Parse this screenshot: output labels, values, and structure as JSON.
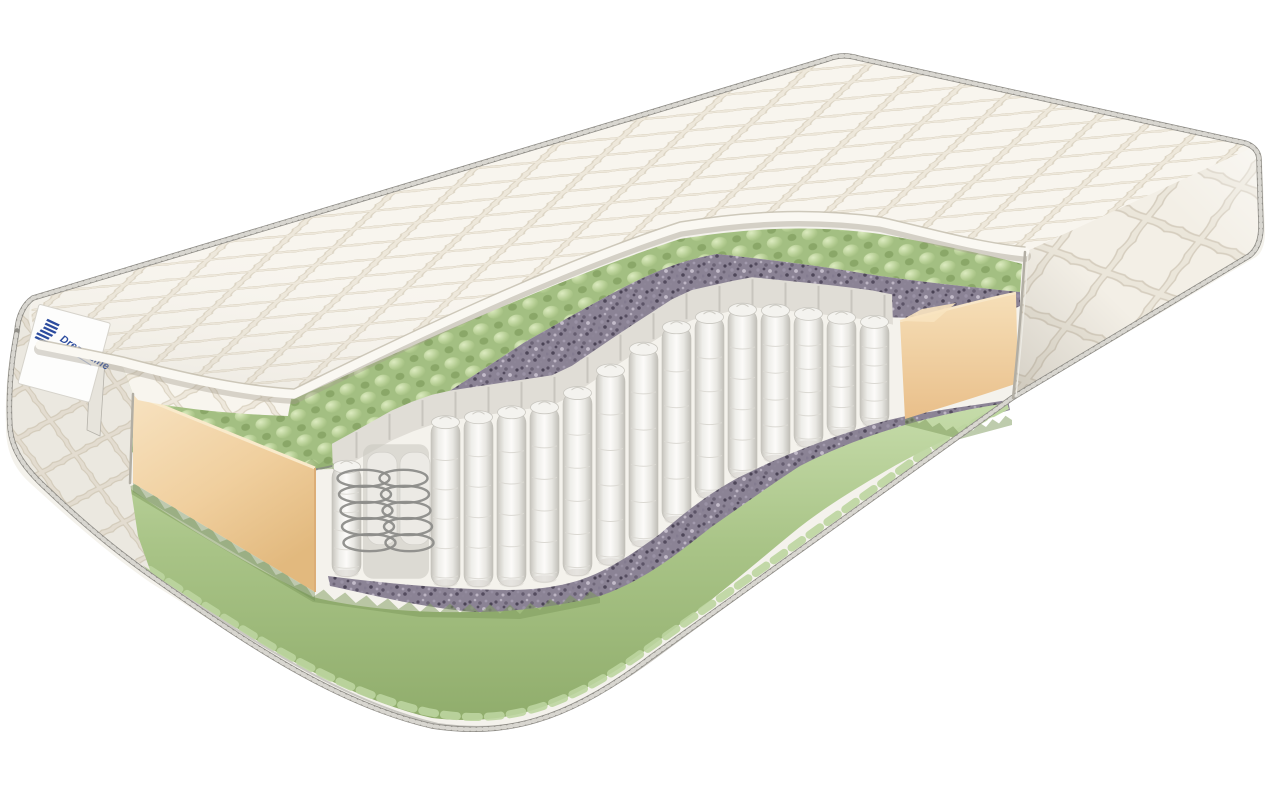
{
  "image": {
    "type": "product-render",
    "subject": "mattress cross-section cutaway on white background"
  },
  "brand": {
    "name": "DreamLine"
  },
  "logo": {
    "icon": "dreamline-stripes-flag-icon",
    "color": "#2b4b9e"
  },
  "materials": {
    "quilted_cover": "#f4f1ea",
    "quilt_seam": "#dbd3c2",
    "foam_wave_green": "#a3bf82",
    "foam_wave_green_light": "#dcebc0",
    "coconut_coir": "#8b8395",
    "pocket_spring_fabric": "#f2f1ed",
    "spring_wire": "#8d8d8a",
    "foam_frame_beige": "#f1d2a4",
    "edge_piping": "#8f8d87",
    "background": "#ffffff"
  },
  "springs": {
    "front_row_slots": 17,
    "exposed_coil_slots": [
      1,
      2
    ],
    "coil_loops": 5
  }
}
